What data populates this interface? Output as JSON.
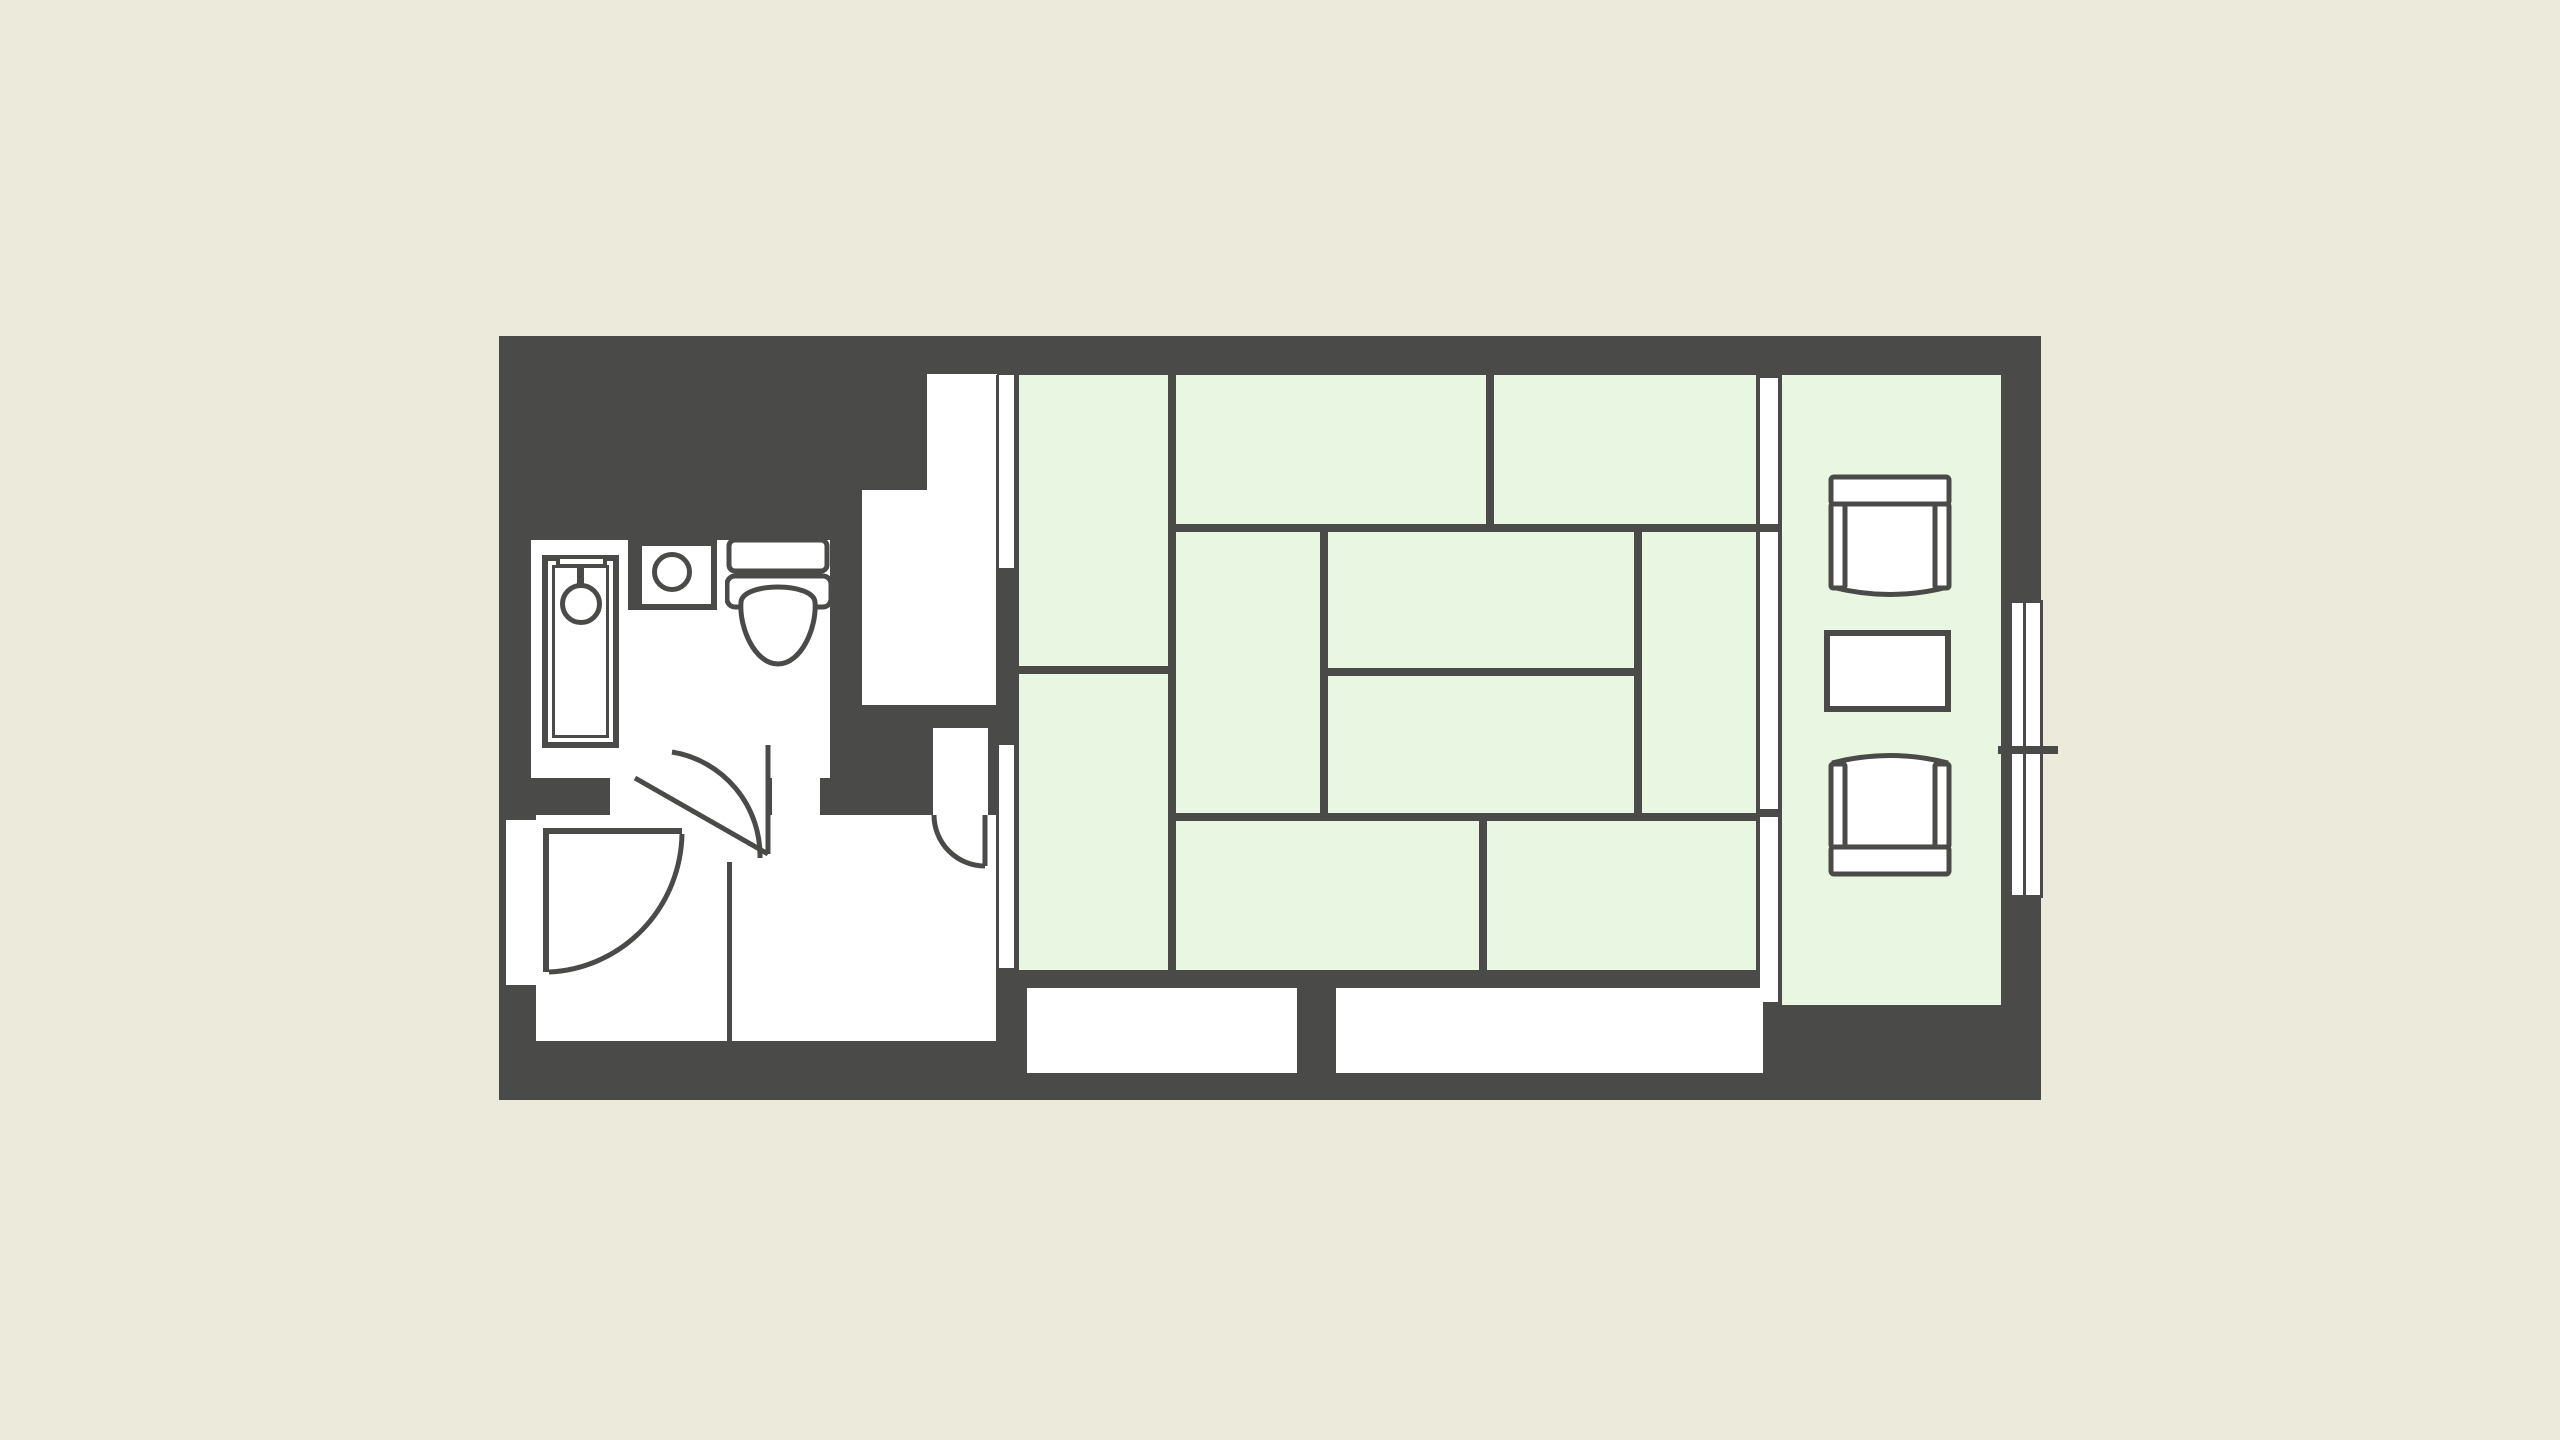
{
  "title": "",
  "colors": {
    "bg": "#ECEADB",
    "wall": "#4A4A48",
    "tatami": "#E9F7E2",
    "floor": "#FFFFFF",
    "stroke": "#4A4A48"
  },
  "floorplan": {
    "type": "japanese-hotel-guestroom",
    "style": "monochrome walls with light-green tatami fill, no text labels",
    "rooms": [
      {
        "name": "bathroom",
        "contains": [
          "bathtub",
          "shower-head",
          "sink",
          "toilet"
        ]
      },
      {
        "name": "entrance-genkan",
        "contains": [
          "entry-door-swing"
        ]
      },
      {
        "name": "hallway",
        "contains": [
          "bathroom-door-swing",
          "corridor-door-swing"
        ]
      },
      {
        "name": "corridor-nook",
        "contains": []
      },
      {
        "name": "tatami-room",
        "mat_cells": 10,
        "contains": [
          "fusuma-sliding-doors"
        ]
      },
      {
        "name": "engawa-sitting-area",
        "contains": [
          "armchair-top",
          "side-table",
          "armchair-bottom"
        ]
      },
      {
        "name": "closets",
        "count": 2
      },
      {
        "name": "balcony-window",
        "symbol": "double-track sliding glass door with tick mark"
      }
    ],
    "fixtures": [
      "bathtub-with-inner-rim",
      "shower-head-icon",
      "washbasin-circle",
      "toilet-tank-seat-bowl",
      "armchair-x2",
      "table",
      "sliding-door-tracks",
      "door-swing-arcs-x3"
    ]
  }
}
